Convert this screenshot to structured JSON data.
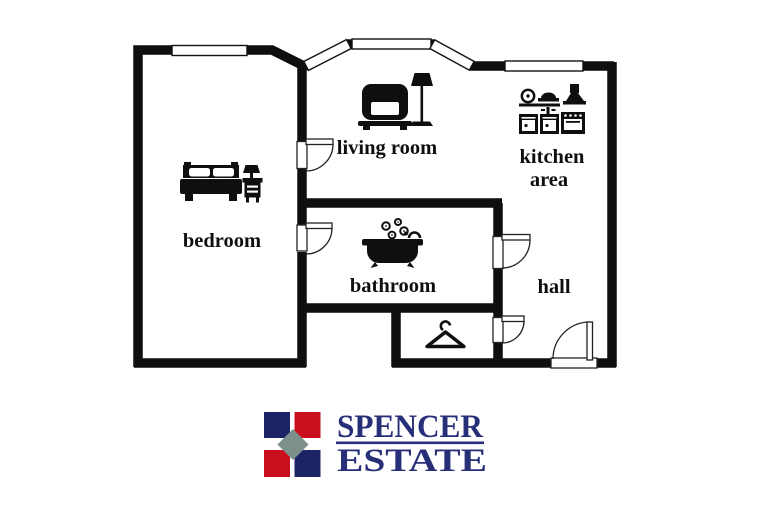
{
  "floor_plan": {
    "rooms": {
      "bedroom": "bedroom",
      "living_room": "living room",
      "kitchen_line1": "kitchen",
      "kitchen_line2": "area",
      "bathroom": "bathroom",
      "hall": "hall"
    },
    "colors": {
      "wall": "#0f0f0f",
      "background": "#ffffff"
    },
    "icons": [
      "bed-icon",
      "nightstand-lamp-icon",
      "armchair-icon",
      "floor-lamp-icon",
      "plate-icon",
      "serving-dish-icon",
      "cooker-hood-icon",
      "sink-cabinet-icon",
      "stove-icon",
      "bathtub-icon",
      "bubbles-icon",
      "coat-hanger-icon",
      "door-swing-icon",
      "window-icon"
    ]
  },
  "logo": {
    "name_line1": "SPENCER",
    "name_line2": "ESTATE",
    "colors": {
      "navy_square": "#1d2466",
      "red_square": "#c90f1d",
      "gray_diamond": "#7d918c",
      "text_navy": "#272f78"
    }
  }
}
